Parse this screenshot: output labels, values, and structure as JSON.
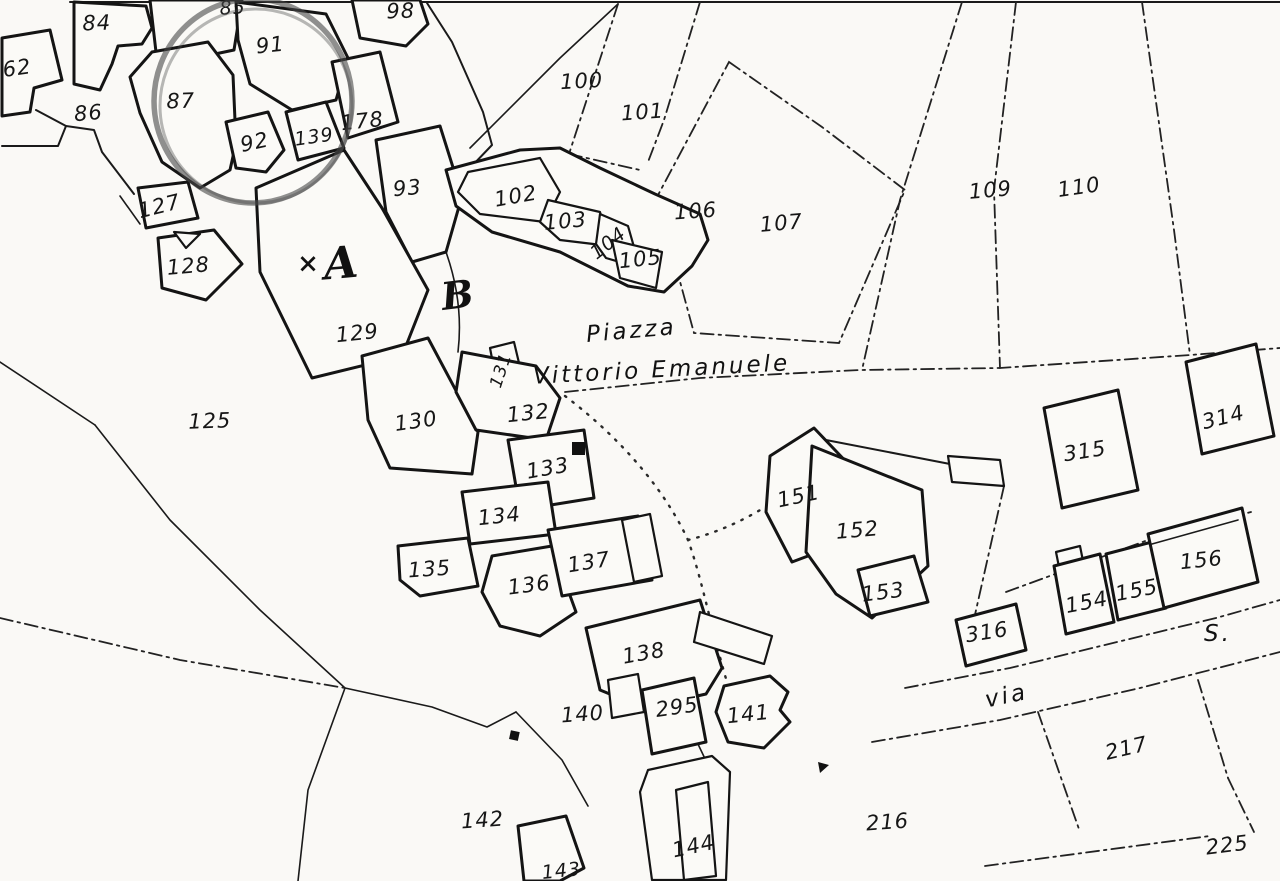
{
  "map": {
    "kind": "cadastral-map-scan",
    "colors": {
      "ink": "#151515",
      "paper": "#faf9f6",
      "annotation": "#474747"
    },
    "place_labels": [
      {
        "text": "Piazza",
        "x": 632,
        "y": 338,
        "rot": -5
      },
      {
        "text": "Vittorio Emanuele",
        "x": 662,
        "y": 377,
        "rot": -3
      },
      {
        "text": "via",
        "x": 1008,
        "y": 703,
        "rot": -12
      },
      {
        "text": "S.",
        "x": 1218,
        "y": 641,
        "rot": 0
      }
    ],
    "block_letters": [
      {
        "text": "×",
        "x": 308,
        "y": 272,
        "rot": 0,
        "size": 26
      },
      {
        "text": "A",
        "x": 342,
        "y": 278,
        "rot": -5,
        "size": 44
      },
      {
        "text": "B",
        "x": 459,
        "y": 308,
        "rot": -7,
        "size": 38
      }
    ],
    "parcel_labels": [
      {
        "text": "62",
        "x": 18,
        "y": 75,
        "rot": -8
      },
      {
        "text": "84",
        "x": 97,
        "y": 30,
        "rot": -2
      },
      {
        "text": "85",
        "x": 233,
        "y": 14,
        "rot": -4,
        "size": 19
      },
      {
        "text": "86",
        "x": 89,
        "y": 120,
        "rot": -5
      },
      {
        "text": "87",
        "x": 181,
        "y": 108,
        "rot": -2
      },
      {
        "text": "91",
        "x": 271,
        "y": 52,
        "rot": -6
      },
      {
        "text": "92",
        "x": 256,
        "y": 149,
        "rot": -12
      },
      {
        "text": "139",
        "x": 315,
        "y": 143,
        "rot": -8,
        "size": 19
      },
      {
        "text": "178",
        "x": 363,
        "y": 128,
        "rot": -6
      },
      {
        "text": "98",
        "x": 401,
        "y": 18,
        "rot": -2
      },
      {
        "text": "93",
        "x": 408,
        "y": 195,
        "rot": -5
      },
      {
        "text": "100",
        "x": 582,
        "y": 88,
        "rot": -3
      },
      {
        "text": "101",
        "x": 643,
        "y": 119,
        "rot": -4
      },
      {
        "text": "102",
        "x": 517,
        "y": 203,
        "rot": -10
      },
      {
        "text": "103",
        "x": 566,
        "y": 228,
        "rot": -5
      },
      {
        "text": "104",
        "x": 612,
        "y": 248,
        "rot": -38,
        "size": 19
      },
      {
        "text": "105",
        "x": 641,
        "y": 266,
        "rot": -6
      },
      {
        "text": "106",
        "x": 696,
        "y": 218,
        "rot": -4
      },
      {
        "text": "107",
        "x": 782,
        "y": 230,
        "rot": -5
      },
      {
        "text": "109",
        "x": 991,
        "y": 197,
        "rot": -5
      },
      {
        "text": "110",
        "x": 1080,
        "y": 194,
        "rot": -8
      },
      {
        "text": "127",
        "x": 161,
        "y": 213,
        "rot": -14
      },
      {
        "text": "128",
        "x": 189,
        "y": 273,
        "rot": -5
      },
      {
        "text": "129",
        "x": 358,
        "y": 340,
        "rot": -6
      },
      {
        "text": "125",
        "x": 210,
        "y": 428,
        "rot": -2
      },
      {
        "text": "130",
        "x": 417,
        "y": 428,
        "rot": -8
      },
      {
        "text": "131",
        "x": 506,
        "y": 372,
        "rot": -72,
        "size": 17
      },
      {
        "text": "132",
        "x": 529,
        "y": 420,
        "rot": -6
      },
      {
        "text": "133",
        "x": 549,
        "y": 475,
        "rot": -10
      },
      {
        "text": "134",
        "x": 500,
        "y": 523,
        "rot": -6
      },
      {
        "text": "135",
        "x": 430,
        "y": 576,
        "rot": -4
      },
      {
        "text": "136",
        "x": 530,
        "y": 592,
        "rot": -7
      },
      {
        "text": "137",
        "x": 590,
        "y": 569,
        "rot": -9
      },
      {
        "text": "138",
        "x": 645,
        "y": 660,
        "rot": -10
      },
      {
        "text": "140",
        "x": 583,
        "y": 721,
        "rot": -4
      },
      {
        "text": "295",
        "x": 678,
        "y": 714,
        "rot": -8
      },
      {
        "text": "141",
        "x": 749,
        "y": 721,
        "rot": -6
      },
      {
        "text": "142",
        "x": 483,
        "y": 827,
        "rot": -4
      },
      {
        "text": "143",
        "x": 562,
        "y": 877,
        "rot": -6,
        "size": 19
      },
      {
        "text": "144",
        "x": 695,
        "y": 853,
        "rot": -12
      },
      {
        "text": "151",
        "x": 800,
        "y": 503,
        "rot": -12
      },
      {
        "text": "152",
        "x": 858,
        "y": 537,
        "rot": -5
      },
      {
        "text": "153",
        "x": 884,
        "y": 599,
        "rot": -7
      },
      {
        "text": "316",
        "x": 988,
        "y": 639,
        "rot": -9
      },
      {
        "text": "154",
        "x": 1088,
        "y": 609,
        "rot": -11
      },
      {
        "text": "155",
        "x": 1138,
        "y": 597,
        "rot": -11
      },
      {
        "text": "156",
        "x": 1202,
        "y": 567,
        "rot": -6
      },
      {
        "text": "314",
        "x": 1225,
        "y": 424,
        "rot": -14
      },
      {
        "text": "315",
        "x": 1086,
        "y": 458,
        "rot": -9
      },
      {
        "text": "216",
        "x": 888,
        "y": 829,
        "rot": -4
      },
      {
        "text": "217",
        "x": 1128,
        "y": 755,
        "rot": -13
      },
      {
        "text": "225",
        "x": 1228,
        "y": 852,
        "rot": -7
      }
    ],
    "annotation_circle": {
      "cx": 253,
      "cy": 101,
      "rx": 99,
      "ry": 102,
      "color": "#474747"
    }
  }
}
